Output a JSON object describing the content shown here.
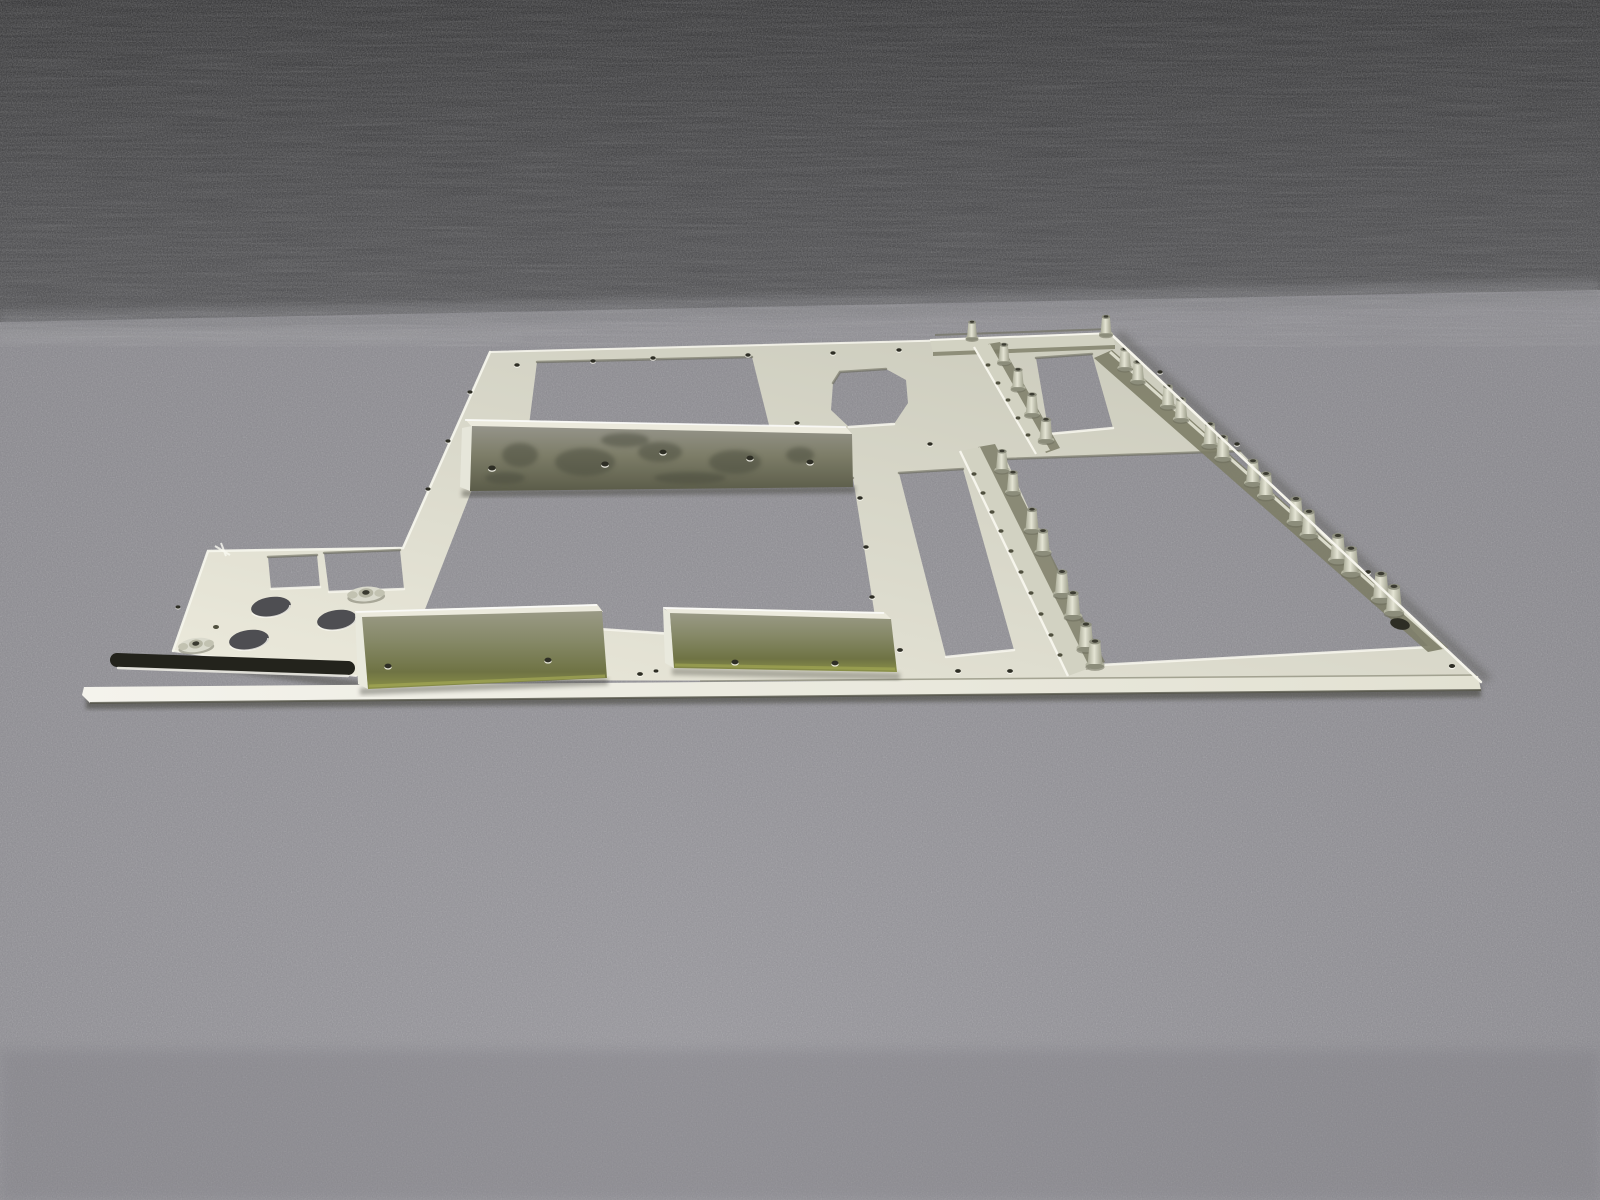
{
  "meta": {
    "type": "photograph",
    "alt_text": "A flat pale-green aluminum avionics mounting panel with rectangular cutouts, riveted olive-drab stiffener blocks, flanged rails and threaded standoffs, lying on two-tone gray carpet"
  },
  "colors": {
    "carpet_dark_top": "#29292b",
    "carpet_dark": "#3f3f42",
    "carpet_light": "#87868c",
    "carpet_light_bright": "#97969c",
    "panel": "#d9d8ca",
    "panel_bright": "#efeee4",
    "panel_dark": "#c7c7b7",
    "edge_highlight": "#f6f5ec",
    "edge_shadow": "#626252",
    "rail": "#d2d2c2",
    "rail_web": "#7d7d67",
    "block_face_top": "#96958a",
    "block_face_mid": "#7d7d64",
    "block_face_bottom": "#5d5e3f",
    "block_sheen": "#a8ad56",
    "block_top_face": "#eceadd",
    "standoff_body": "#c9cab8",
    "standoff_top": "#8f9080",
    "standoff_hole": "#3c3c32",
    "hole_dark": "#2e2e25",
    "slot_dark": "#23231c",
    "stain": "#4a4b3c",
    "shadow": "#3c3c36",
    "oval_hole": "#4e4e52"
  },
  "scene": {
    "background": {
      "label": "two-tone gray carpet",
      "upper_region": "dark charcoal carpet",
      "lower_region": "light gray speckled carpet"
    },
    "subject": {
      "label": "sheet-metal equipment mounting panel",
      "material": "aluminum, pale green-gray chromate finish",
      "parts": [
        {
          "name": "main-plate",
          "description": "flat plate seen in perspective with six rectangular cutouts and one rounded cutout"
        },
        {
          "name": "left-extension",
          "description": "left tab with two square cutouts, three oval holes, small holes and a long slot"
        },
        {
          "name": "stiffener-blocks",
          "count": 3,
          "description": "riveted angle blocks, olive-drab faces, two holes each"
        },
        {
          "name": "mounting-rails",
          "count": 4,
          "description": "flanged rails carrying threaded standoffs"
        },
        {
          "name": "standoffs",
          "count": 28,
          "description": "cylindrical threaded spacers riveted to the rails"
        },
        {
          "name": "nutplate-fasteners",
          "count": 2
        },
        {
          "name": "bottom-flange-strip",
          "count": 1,
          "description": "thin bright strip along the bottom edge"
        },
        {
          "name": "rivet-holes",
          "count": "numerous",
          "description": "small holes along all edges"
        }
      ]
    }
  }
}
